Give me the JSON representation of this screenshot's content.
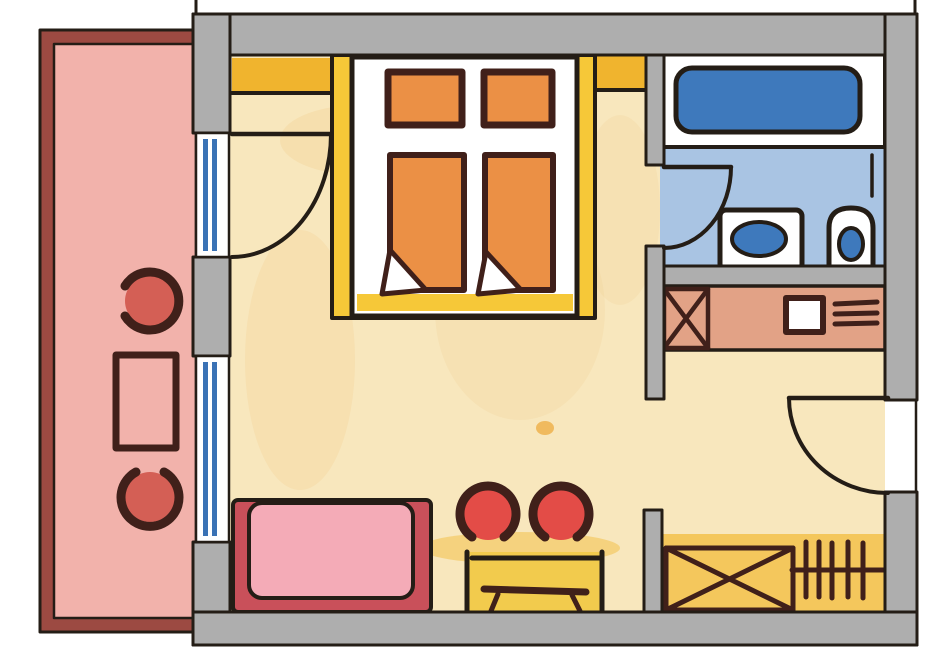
{
  "drawing": {
    "kind": "hand-drawn apartment floor plan",
    "rooms": [
      {
        "name": "balcony",
        "fill": "pink"
      },
      {
        "name": "main-room",
        "fill": "cream-yellow"
      },
      {
        "name": "bathroom",
        "fill": "light-blue"
      },
      {
        "name": "kitchenette",
        "fill": "salmon"
      }
    ],
    "furniture": [
      "balcony-chair-top",
      "balcony-table",
      "balcony-chair-bottom",
      "double-bed-with-two-pillows-and-two-duvets",
      "bathtub",
      "washbasin",
      "toilet",
      "refrigerator-x-symbol",
      "kitchen-sink",
      "stove-burners",
      "sofa",
      "round-chair-left",
      "round-chair-right",
      "desk-with-stool",
      "wardrobe-x-symbol",
      "radiator"
    ],
    "openings": [
      "balcony-door-with-swing-arc",
      "window-left-wall",
      "bathroom-door-with-swing-arc",
      "entrance-door-with-swing-arc"
    ]
  },
  "colors": {
    "paper": "#ffffff",
    "ink": "#241d16",
    "wall": "#aeaeae",
    "balcony_border": "#9c4a42",
    "balcony_fill": "#f2b2ab",
    "balcony_furniture": "#d45f55",
    "furniture_ink": "#40201a",
    "room_fill": "#f8e7bd",
    "room_stain": "#f2cd8a",
    "gold_band": "#f0b42e",
    "bed_frame": "#f6c838",
    "bed_platform": "#ffffff",
    "bedding": "#eb9045",
    "bath_floor": "#a9c4e3",
    "tub": "#3e79bc",
    "window_glass": "#3a72b5",
    "kitchen": "#e2a286",
    "sofa_frame": "#c9505a",
    "sofa_seat": "#f4abb7",
    "chair_red": "#e34c47",
    "desk": "#f2cb4d",
    "amber": "#f3c14b"
  }
}
